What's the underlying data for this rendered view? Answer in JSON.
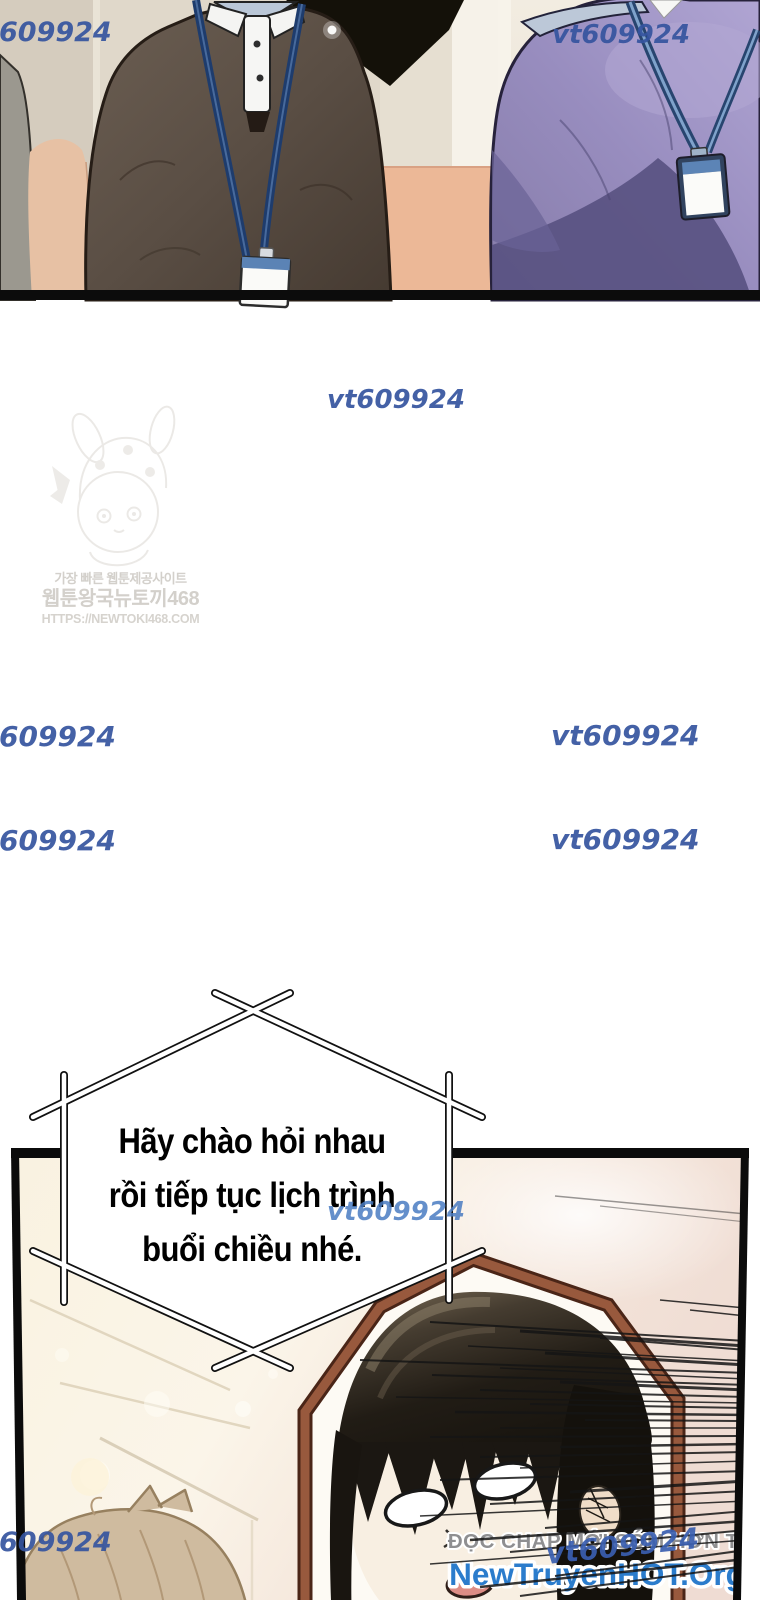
{
  "watermark": {
    "full": "vt609924",
    "cropped": "609924",
    "color": "#35549f",
    "bubble_color": "#4a7cc2"
  },
  "site_logo": {
    "tagline": "가장 빠른 웹툰제공사이트",
    "name": "웹툰왕국뉴토끼468",
    "url": "HTTPS://NEWTOKI468.COM"
  },
  "speech_bubble": {
    "lines": [
      "Hãy chào hỏi nhau",
      "rồi tiếp tục lịch trình",
      "buổi chiều nhé."
    ]
  },
  "promo": {
    "tagline": "ĐỌC CHAP MỚI SỚM HƠN TẠI",
    "site": "NewTruyenHOT.Org",
    "tagline_color": "#8f8f91",
    "site_color": "#2b7ccc"
  },
  "panel_colors": {
    "panel_border": "#0b0b0b",
    "octagon_frame": "#98593d",
    "ceiling_cream": "#f8f1df",
    "salmon_wall": "#ecb897",
    "brown_sweater": "#5a4e44",
    "purple_sweater": "#988dbf",
    "lanyard_navy": "#1e3c6d",
    "lanyard_blue": "#7fa2cb"
  }
}
